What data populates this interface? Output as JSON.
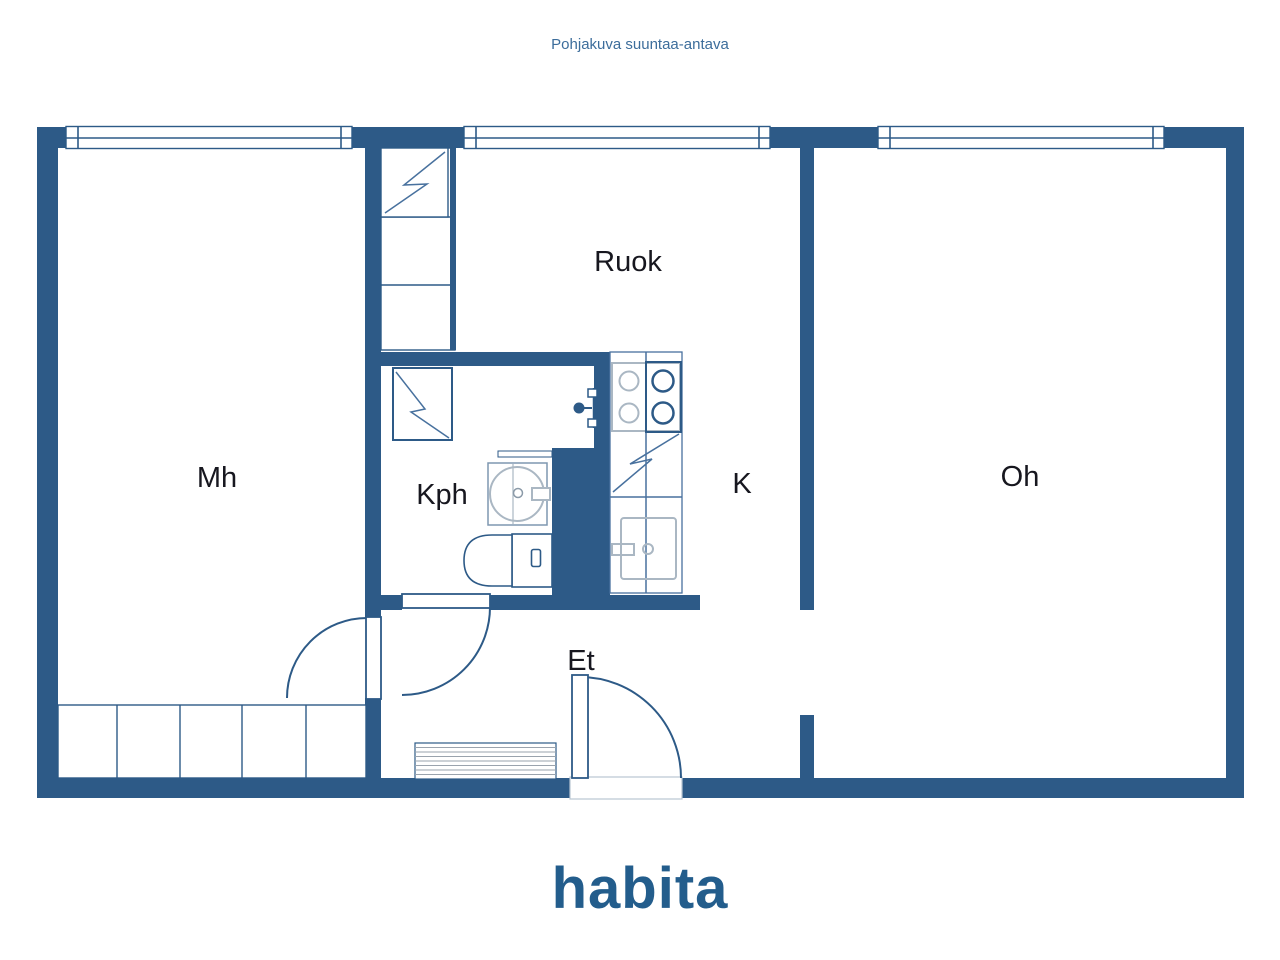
{
  "header": {
    "title": "Pohjakuva suuntaa-antava"
  },
  "rooms": {
    "mh": {
      "label": "Mh"
    },
    "ruok": {
      "label": "Ruok"
    },
    "kph": {
      "label": "Kph"
    },
    "k": {
      "label": "K"
    },
    "oh": {
      "label": "Oh"
    },
    "et": {
      "label": "Et"
    }
  },
  "fixtures": {
    "closet_ruok": "wardrobe-with-bolt",
    "closet_row_mh": "wardrobe-row-5",
    "washing_machine": "washer-with-bolt",
    "fridge": "fridge-with-bolt",
    "stove": "stove-4-burners",
    "kitchen_sink": "kitchen-sink",
    "bathroom_sink": "round-basin",
    "toilet": "wc",
    "shower": "shower-valve",
    "entry_mat": "striped-mat"
  },
  "footer": {
    "logo": "habita"
  },
  "colors": {
    "wall": "#2d5a87",
    "label": "#17171f",
    "title": "#3c6d9b",
    "logo": "#235d8c",
    "fix-light": "#aab7c3",
    "fix-mid": "#48719e",
    "stripe": "#9aa3ad",
    "frame": "#b9c6d2"
  }
}
